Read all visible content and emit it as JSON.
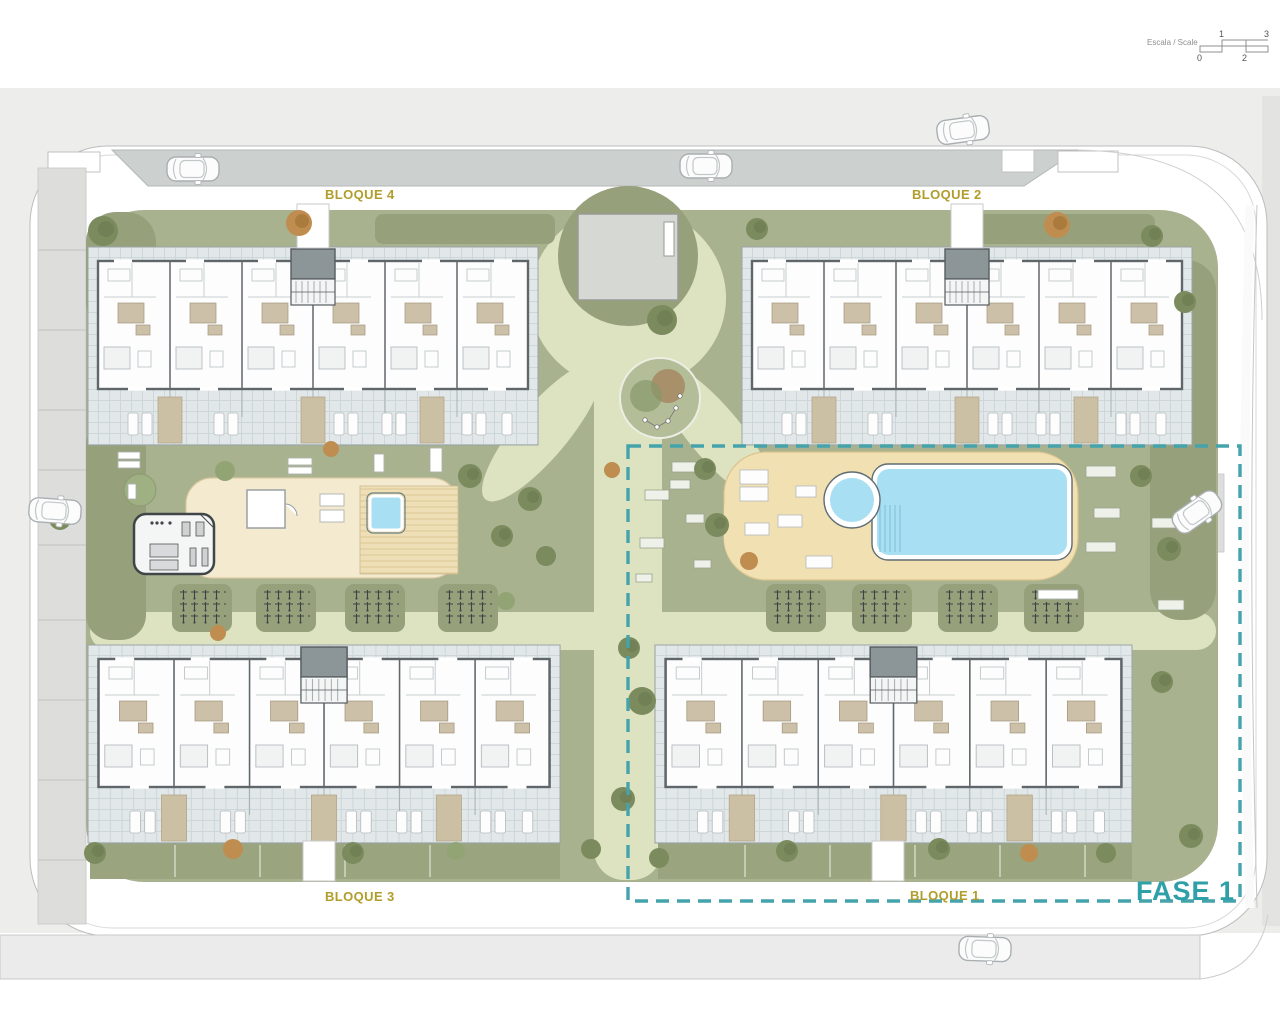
{
  "scale_bar": {
    "label": "Escala / Scale",
    "ticks": {
      "t0": "0",
      "t1": "1",
      "t2": "2",
      "t3": "3"
    }
  },
  "blocks": {
    "bloque4": {
      "label": "BLOQUE 4"
    },
    "bloque2": {
      "label": "BLOQUE 2"
    },
    "bloque3": {
      "label": "BLOQUE 3"
    },
    "bloque1": {
      "label": "BLOQUE 1"
    }
  },
  "phase": {
    "label": "FASE 1"
  },
  "colors": {
    "phase_boundary": "#44a3ab",
    "block_label": "#b19d2b",
    "phase_label": "#2f9fa8",
    "pool_water": "#a8dff2",
    "pool_deck": "#f1e0b2",
    "amenity_deck": "#f4ead0",
    "lawn": "#a9b28f",
    "path": "#dde3c1",
    "hedge": "#96a17b",
    "road": "#ccd0cf",
    "context": "#ededec",
    "terrace_tiles": "#e2e8e9"
  }
}
